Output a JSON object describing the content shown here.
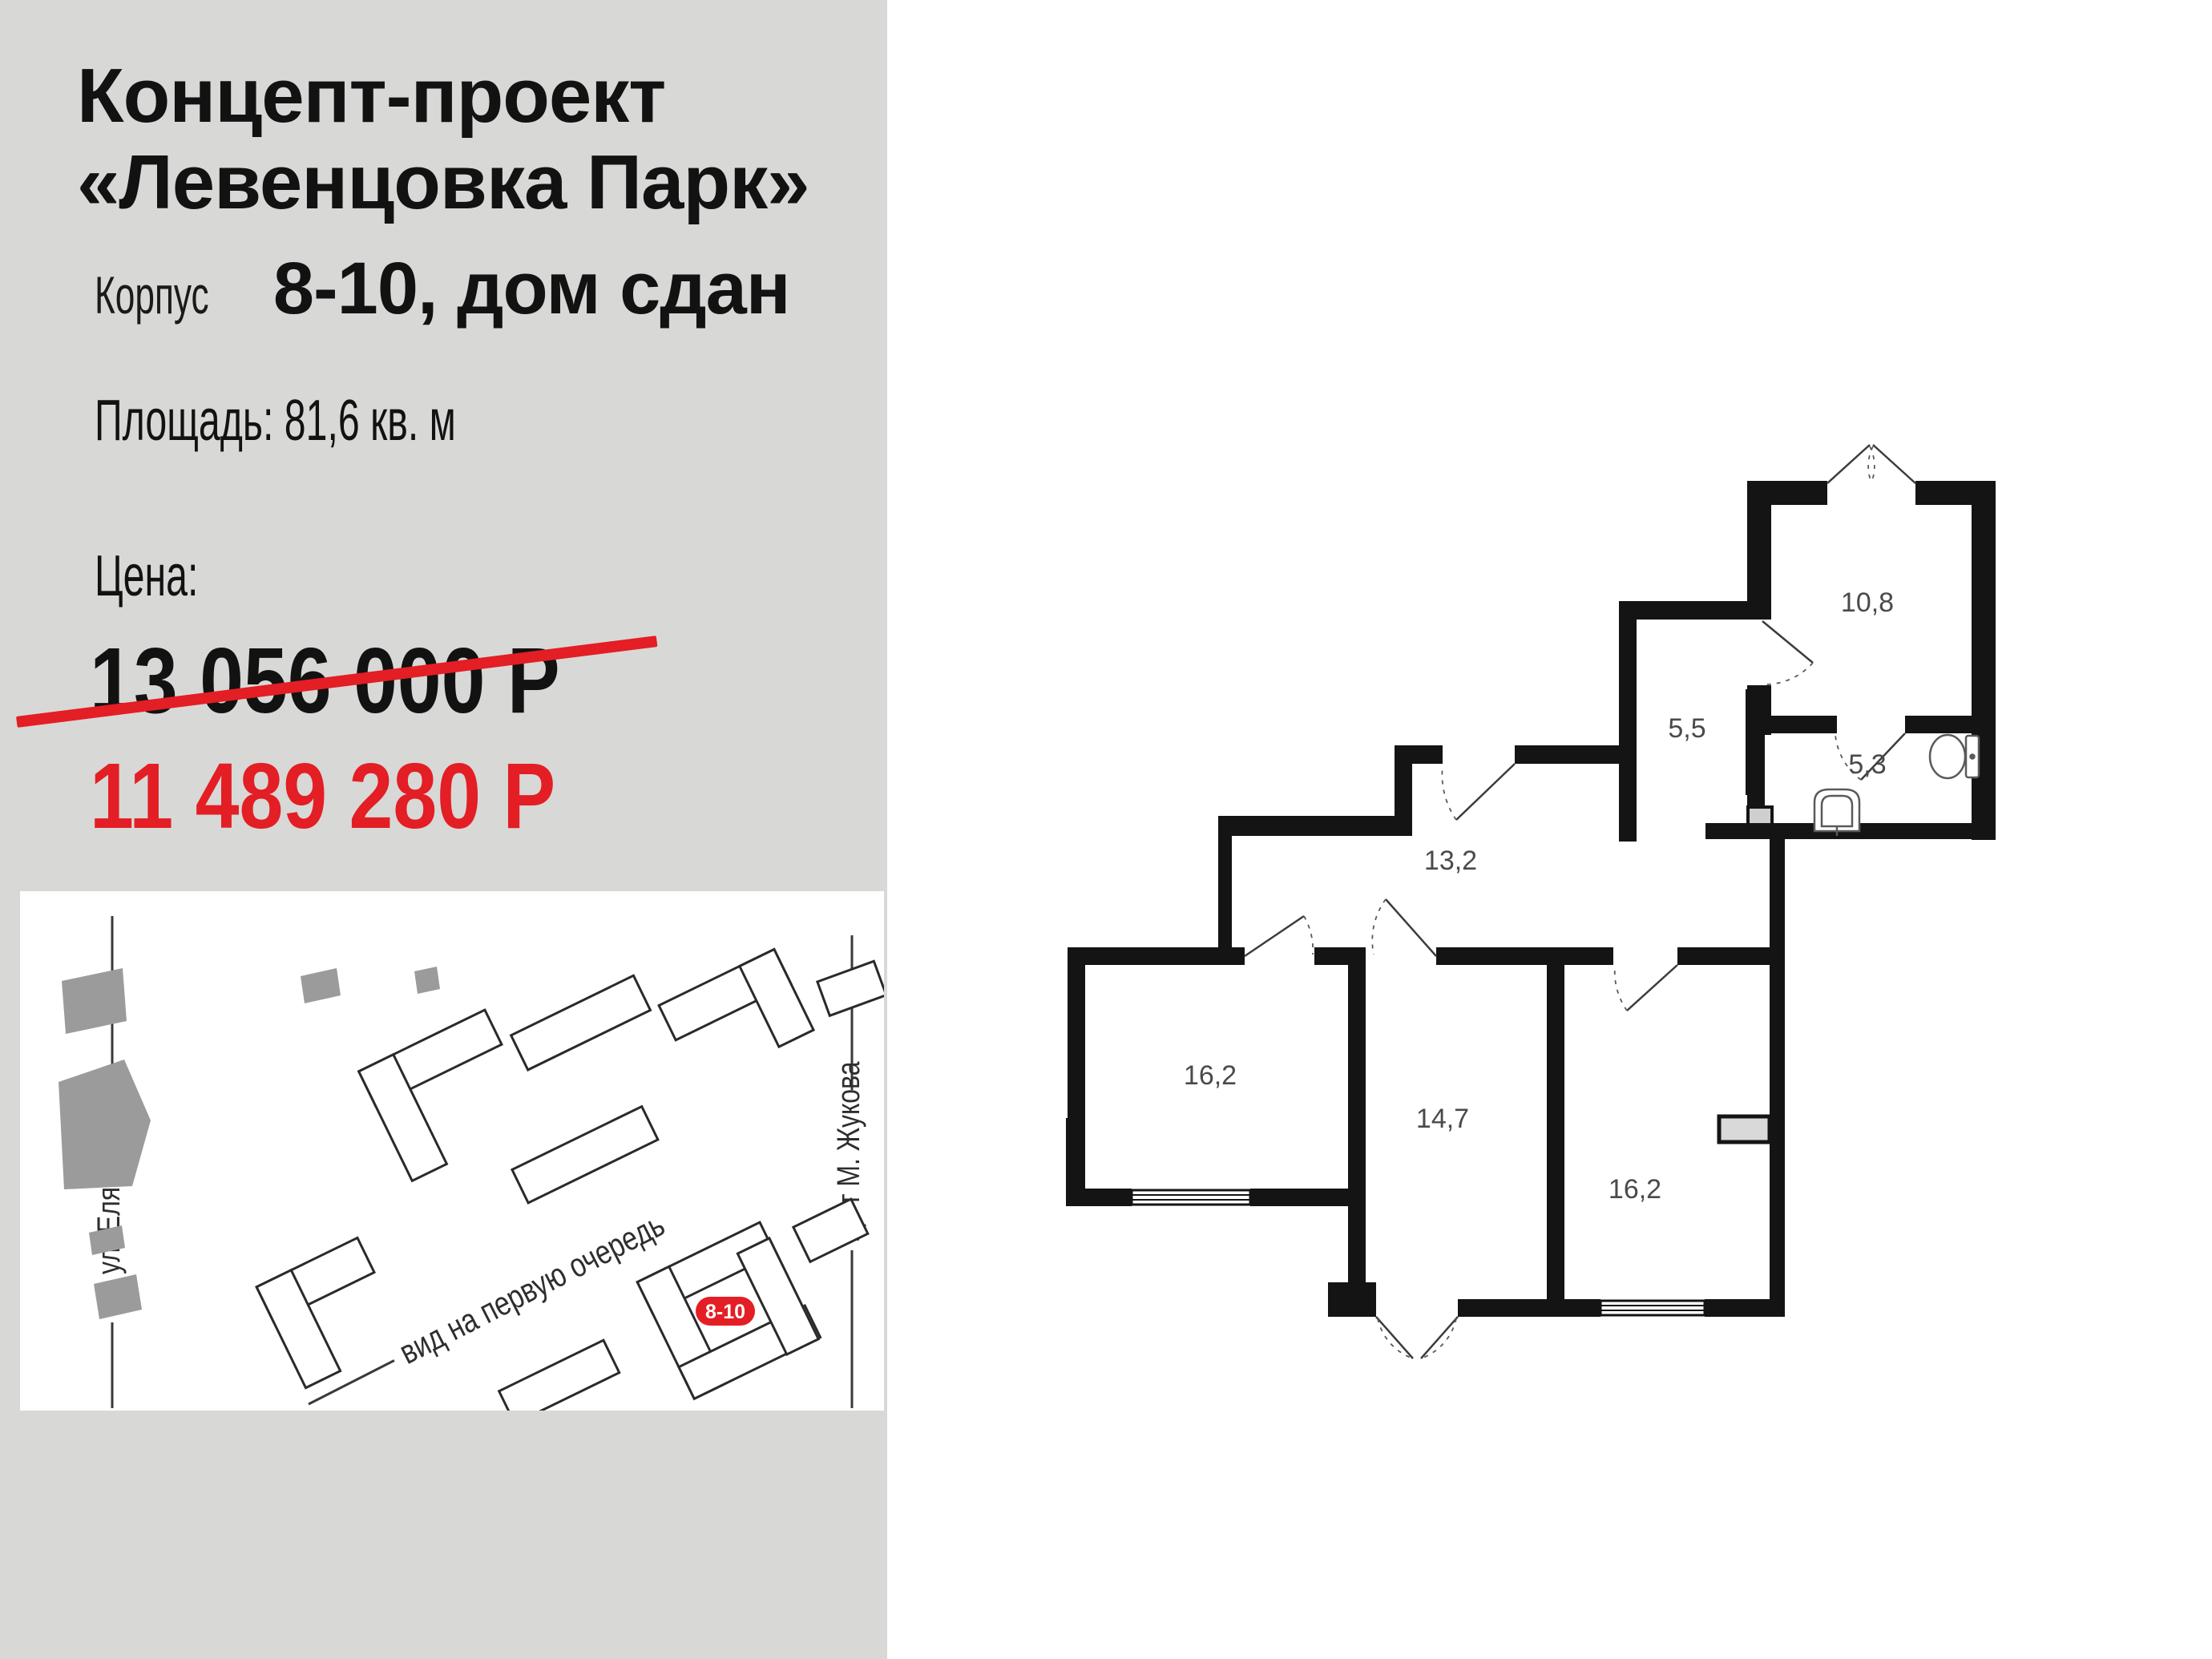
{
  "sidebar": {
    "title": "Концепт-проект\n«Левенцовка Парк»",
    "building_label": "Корпус",
    "building_value": "8-10, дом сдан",
    "area_line": "Площадь: 81,6 кв. м",
    "price_label": "Цена:",
    "old_price": "13 056 000 Р",
    "new_price": "11 489 280 Р",
    "accent_red": "#e31e24",
    "background_gray": "#d8d8d6"
  },
  "site_map": {
    "street_left": "ул. Еляна",
    "street_right": "пр-т М. Жукова",
    "view_note": "вид на первую очередь",
    "building_badge": "8-10",
    "badge_color": "#e31e24"
  },
  "floor_plan": {
    "wall_color": "#141414",
    "rooms": [
      {
        "name": "room-10-8",
        "area_label": "10,8"
      },
      {
        "name": "hall-5-5",
        "area_label": "5,5"
      },
      {
        "name": "bathroom-5-3",
        "area_label": "5,3"
      },
      {
        "name": "corridor-13-2",
        "area_label": "13,2"
      },
      {
        "name": "room-16-2-left",
        "area_label": "16,2"
      },
      {
        "name": "room-14-7",
        "area_label": "14,7"
      },
      {
        "name": "room-16-2-right",
        "area_label": "16,2"
      }
    ]
  }
}
